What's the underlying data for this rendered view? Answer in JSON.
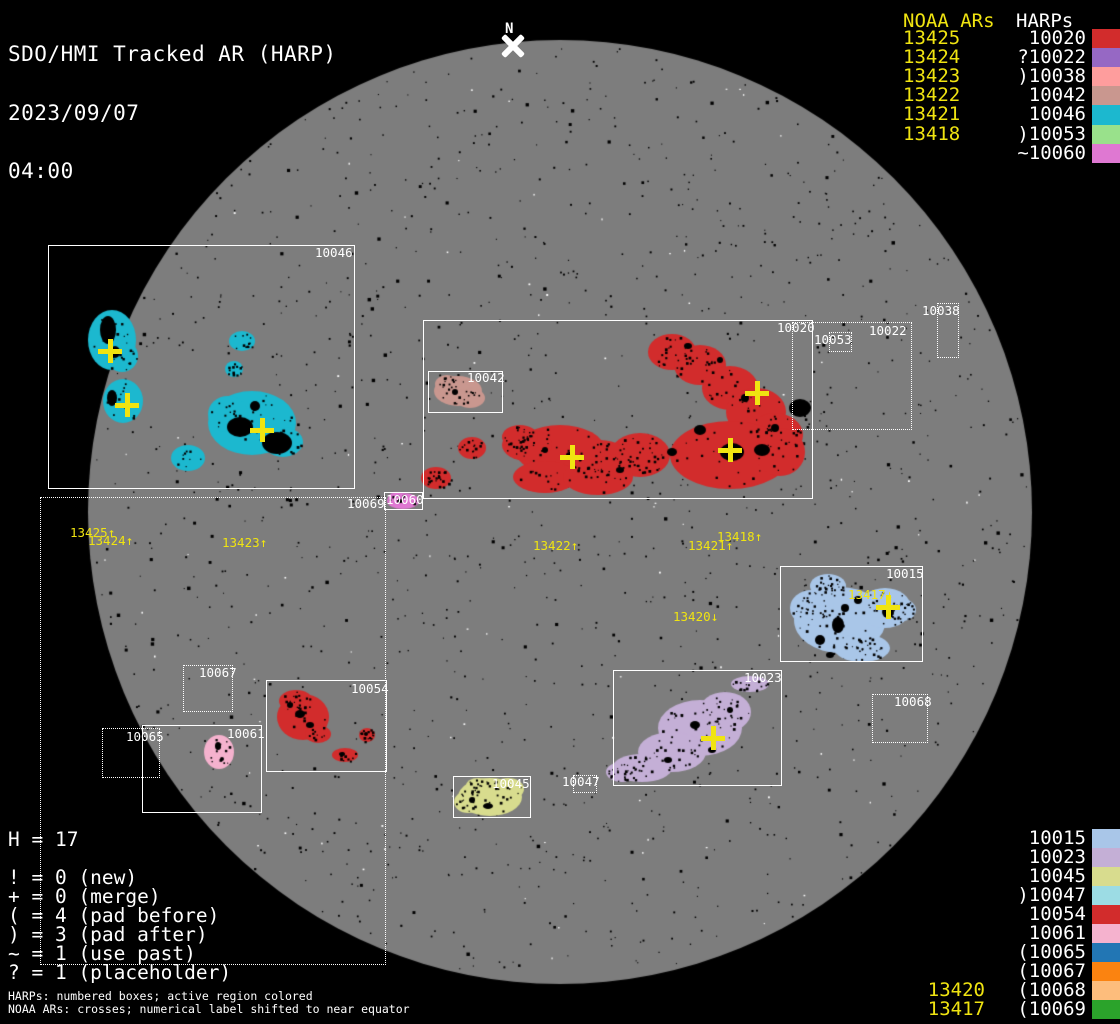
{
  "header": {
    "title": "SDO/HMI Tracked AR (HARP)",
    "date": "2023/09/07",
    "time": "04:00"
  },
  "north_marker": {
    "label": "N"
  },
  "colors": {
    "background": "#000000",
    "disk": "#7d7d7d",
    "speckle_black": "#000000",
    "speckle_white": "#ffffff",
    "noaa_yellow": "#f0e411",
    "box_white": "#ffffff"
  },
  "legend_top": {
    "noaa_header": "NOAA ARs",
    "harp_header": "HARPs",
    "rows": [
      {
        "noaa": "13425",
        "prefix": "",
        "harp": "10020",
        "color": "#d22c2c"
      },
      {
        "noaa": "13424",
        "prefix": "?",
        "harp": "10022",
        "color": "#9668c4"
      },
      {
        "noaa": "13423",
        "prefix": ")",
        "harp": "10038",
        "color": "#fe9d9d"
      },
      {
        "noaa": "13422",
        "prefix": "",
        "harp": "10042",
        "color": "#c9978f"
      },
      {
        "noaa": "13421",
        "prefix": "",
        "harp": "10046",
        "color": "#1cb8cf"
      },
      {
        "noaa": "13418",
        "prefix": ")",
        "harp": "10053",
        "color": "#99e18b"
      },
      {
        "noaa": "",
        "prefix": "~",
        "harp": "10060",
        "color": "#df78d2"
      }
    ]
  },
  "legend_bottom": {
    "rows": [
      {
        "noaa": "",
        "prefix": "",
        "harp": "10015",
        "color": "#a9c6e8"
      },
      {
        "noaa": "",
        "prefix": "",
        "harp": "10023",
        "color": "#c4afd6"
      },
      {
        "noaa": "",
        "prefix": "",
        "harp": "10045",
        "color": "#d8dc8e"
      },
      {
        "noaa": "",
        "prefix": ")",
        "harp": "10047",
        "color": "#9cdce4"
      },
      {
        "noaa": "",
        "prefix": "",
        "harp": "10054",
        "color": "#d22c2c"
      },
      {
        "noaa": "",
        "prefix": "",
        "harp": "10061",
        "color": "#f5b2ce"
      },
      {
        "noaa": "",
        "prefix": "(",
        "harp": "10065",
        "color": "#2276b4"
      },
      {
        "noaa": "",
        "prefix": "(",
        "harp": "10067",
        "color": "#fb8310"
      },
      {
        "noaa": "13420",
        "prefix": "(",
        "harp": "10068",
        "color": "#fdbd7c"
      },
      {
        "noaa": "13417",
        "prefix": "(",
        "harp": "10069",
        "color": "#2ba32b"
      }
    ]
  },
  "stats": {
    "harp_count": "H = 17",
    "lines": [
      "! = 0 (new)",
      "+ = 0 (merge)",
      "( = 4 (pad before)",
      ") = 3 (pad after)",
      "~ = 1 (use past)",
      "? = 1 (placeholder)"
    ]
  },
  "footnotes": [
    "HARPs: numbered boxes; active region colored",
    "NOAA ARs: crosses; numerical label shifted to near equator"
  ],
  "disk_boxes": [
    {
      "id": "10046",
      "style": "solid",
      "x": 48,
      "y": 245,
      "w": 307,
      "h": 244,
      "lx": 315,
      "ly": 246
    },
    {
      "id": "10020",
      "style": "solid",
      "x": 423,
      "y": 320,
      "w": 390,
      "h": 179,
      "lx": 777,
      "ly": 321
    },
    {
      "id": "10042",
      "style": "solid",
      "x": 428,
      "y": 371,
      "w": 75,
      "h": 42,
      "lx": 467,
      "ly": 371
    },
    {
      "id": "10060",
      "style": "solid",
      "x": 384,
      "y": 492,
      "w": 39,
      "h": 18,
      "lx": 386,
      "ly": 493
    },
    {
      "id": "10015",
      "style": "solid",
      "x": 780,
      "y": 566,
      "w": 143,
      "h": 96,
      "lx": 886,
      "ly": 567
    },
    {
      "id": "10023",
      "style": "solid",
      "x": 613,
      "y": 670,
      "w": 169,
      "h": 116,
      "lx": 744,
      "ly": 671
    },
    {
      "id": "10054",
      "style": "solid",
      "x": 266,
      "y": 680,
      "w": 121,
      "h": 92,
      "lx": 351,
      "ly": 682
    },
    {
      "id": "10061",
      "style": "solid",
      "x": 142,
      "y": 725,
      "w": 120,
      "h": 88,
      "lx": 227,
      "ly": 727
    },
    {
      "id": "10045",
      "style": "solid",
      "x": 453,
      "y": 776,
      "w": 78,
      "h": 42,
      "lx": 492,
      "ly": 777
    },
    {
      "id": "10022",
      "style": "dotted",
      "x": 792,
      "y": 322,
      "w": 120,
      "h": 108,
      "lx": 869,
      "ly": 324
    },
    {
      "id": "10053",
      "style": "dotted",
      "x": 829,
      "y": 332,
      "w": 23,
      "h": 20,
      "lx": 814,
      "ly": 333
    },
    {
      "id": "10038",
      "style": "dotted",
      "x": 937,
      "y": 303,
      "w": 22,
      "h": 55,
      "lx": 922,
      "ly": 304
    },
    {
      "id": "10067",
      "style": "dotted",
      "x": 183,
      "y": 665,
      "w": 50,
      "h": 47,
      "lx": 199,
      "ly": 666
    },
    {
      "id": "10065",
      "style": "dotted",
      "x": 102,
      "y": 728,
      "w": 58,
      "h": 50,
      "lx": 126,
      "ly": 730
    },
    {
      "id": "10068",
      "style": "dotted",
      "x": 872,
      "y": 694,
      "w": 56,
      "h": 49,
      "lx": 894,
      "ly": 695
    },
    {
      "id": "10047",
      "style": "dotted",
      "x": 573,
      "y": 775,
      "w": 24,
      "h": 18,
      "lx": 562,
      "ly": 775
    },
    {
      "id": "10069",
      "style": "dotted",
      "x": 40,
      "y": 497,
      "w": 346,
      "h": 468,
      "lx": 347,
      "ly": 497
    }
  ],
  "noaa_disk_labels": [
    {
      "text": "13425↑",
      "x": 70,
      "y": 526
    },
    {
      "text": "13424↑",
      "x": 88,
      "y": 534
    },
    {
      "text": "13423↑",
      "x": 222,
      "y": 536
    },
    {
      "text": "13422↑",
      "x": 533,
      "y": 539
    },
    {
      "text": "13421↑",
      "x": 688,
      "y": 539
    },
    {
      "text": "13418↑",
      "x": 717,
      "y": 530
    },
    {
      "text": "13420↓",
      "x": 673,
      "y": 610
    },
    {
      "text": "13417↓",
      "x": 848,
      "y": 588
    }
  ],
  "crosses": [
    {
      "x": 110,
      "y": 351
    },
    {
      "x": 127,
      "y": 405
    },
    {
      "x": 262,
      "y": 430
    },
    {
      "x": 572,
      "y": 457
    },
    {
      "x": 730,
      "y": 450
    },
    {
      "x": 757,
      "y": 393
    },
    {
      "x": 888,
      "y": 607
    },
    {
      "x": 713,
      "y": 738
    }
  ],
  "chart_data": {
    "type": "table",
    "title": "SDO/HMI Tracked AR (HARP)",
    "timestamp": "2023/09/07 04:00",
    "harp_total": 17,
    "flag_counts": {
      "new": 0,
      "merge": 0,
      "pad_before": 4,
      "pad_after": 3,
      "use_past": 1,
      "placeholder": 1
    },
    "noaa_to_harp": [
      [
        "13425",
        "10020"
      ],
      [
        "13424",
        "?10022"
      ],
      [
        "13423",
        ")10038"
      ],
      [
        "13422",
        "10042"
      ],
      [
        "13421",
        "10046"
      ],
      [
        "13418",
        ")10053"
      ],
      [
        "",
        "~10060"
      ],
      [
        "13420",
        "(10068"
      ],
      [
        "13417",
        "(10069"
      ]
    ],
    "unassociated_harps": [
      "10015",
      "10023",
      "10045",
      ")10047",
      "10054",
      "10061",
      "(10065",
      "(10067"
    ]
  }
}
